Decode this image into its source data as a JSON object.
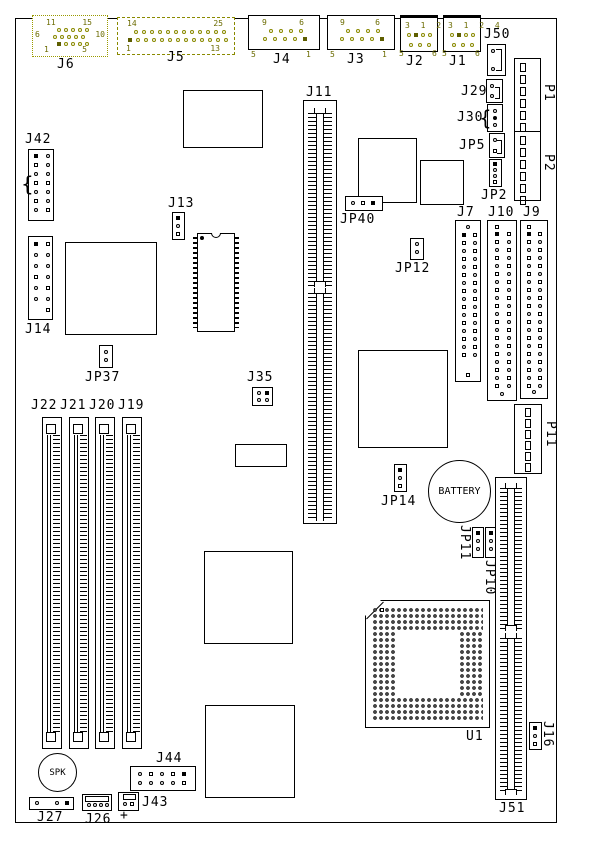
{
  "labels": {
    "j6": "J6",
    "j5": "J5",
    "j4": "J4",
    "j3": "J3",
    "j2": "J2",
    "j1": "J1",
    "j50": "J50",
    "j29": "J29",
    "j30": "J30",
    "jp5": "JP5",
    "jp2": "JP2",
    "p1": "P1",
    "p2": "P2",
    "j42": "J42",
    "j13": "J13",
    "j14": "J14",
    "j11": "J11",
    "jp40": "JP40",
    "jp12": "JP12",
    "j7": "J7",
    "j10": "J10",
    "j9": "J9",
    "jp37": "JP37",
    "j35": "J35",
    "j22": "J22",
    "j21": "J21",
    "j20": "J20",
    "j19": "J19",
    "p11": "P11",
    "jp14": "JP14",
    "battery": "BATTERY",
    "jp11": "JP11",
    "jp10": "JP10",
    "u1": "U1",
    "j51": "J51",
    "j16": "J16",
    "spk": "SPK",
    "j27": "J27",
    "j26": "J26",
    "j43": "J43",
    "j44": "J44",
    "plus": "+"
  },
  "pin_numbers": {
    "j6": {
      "top_left": "11",
      "top_right": "15",
      "mid_left": "6",
      "mid_right": "10",
      "bottom_left": "1",
      "bottom_right": "5"
    },
    "j5": {
      "top_left": "14",
      "top_right": "25",
      "bottom_left": "1",
      "bottom_right": "13"
    },
    "j4": {
      "top_left": "9",
      "top_right": "6",
      "bottom_left": "5",
      "bottom_right": "1"
    },
    "j3": {
      "top_left": "9",
      "top_right": "6",
      "bottom_left": "5",
      "bottom_right": "1"
    },
    "j2": {
      "top_row": "3 1 2 4",
      "bottom_left": "5",
      "bottom_right": "6"
    },
    "j1": {
      "top_row": "3 1 2 4",
      "bottom_left": "5",
      "bottom_right": "6"
    }
  },
  "colors": {
    "line": "#000000",
    "highlight": "#8a8a00",
    "background": "#ffffff"
  }
}
